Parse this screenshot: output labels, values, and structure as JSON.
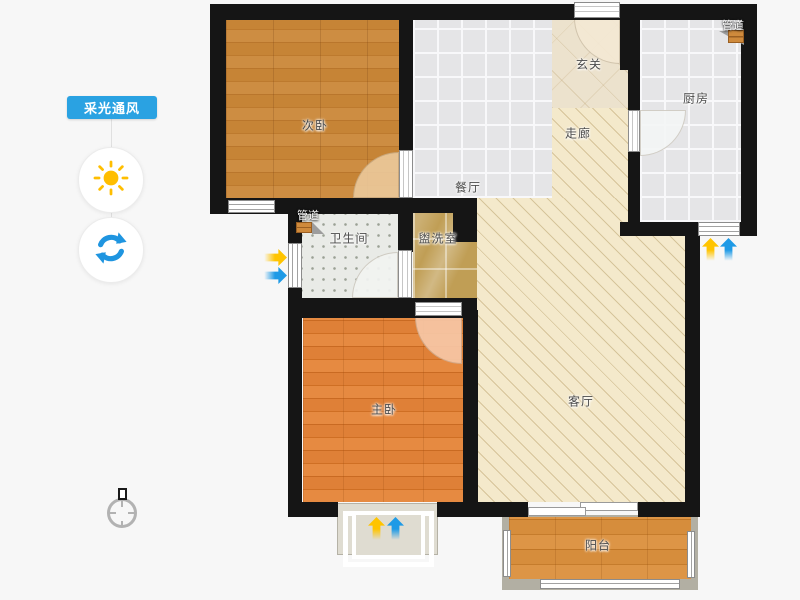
{
  "app": {
    "background": "#f7f7f7"
  },
  "sidebar": {
    "toggle_button": {
      "label": "采光通风",
      "color": "#2aa2e2"
    },
    "sun_tool": {
      "icon": "sun-icon",
      "color": "#ffbe00"
    },
    "refresh_tool": {
      "icon": "refresh-icon",
      "color": "#1f95e0"
    }
  },
  "floorplan": {
    "wall_color": "#151515",
    "rooms": [
      {
        "id": "secondary-bedroom",
        "label": "次卧",
        "floor": "wood"
      },
      {
        "id": "dining-room",
        "label": "餐厅",
        "floor": "gray-tile"
      },
      {
        "id": "entry-hall",
        "label": "玄关",
        "floor": "beige-tile"
      },
      {
        "id": "corridor",
        "label": "走廊",
        "floor": "cream-hatch"
      },
      {
        "id": "kitchen",
        "label": "厨房",
        "floor": "gray-tile"
      },
      {
        "id": "bathroom",
        "label": "卫生间",
        "floor": "dot-tile"
      },
      {
        "id": "washroom",
        "label": "盥洗室",
        "floor": "marble"
      },
      {
        "id": "master-bedroom",
        "label": "主卧",
        "floor": "wood"
      },
      {
        "id": "living-room",
        "label": "客厅",
        "floor": "cream-hatch"
      },
      {
        "id": "balcony",
        "label": "阳台",
        "floor": "wood"
      }
    ],
    "pipes": [
      {
        "label": "管道",
        "location": "kitchen"
      },
      {
        "label": "管道",
        "location": "bathroom"
      }
    ],
    "airflow_arrows": {
      "light_color": "#ffc400",
      "wind_color": "#1e9ae6",
      "locations": [
        "bathroom-window",
        "kitchen-window",
        "master-bay-window"
      ]
    },
    "compass": {
      "icon": "compass-icon"
    }
  }
}
